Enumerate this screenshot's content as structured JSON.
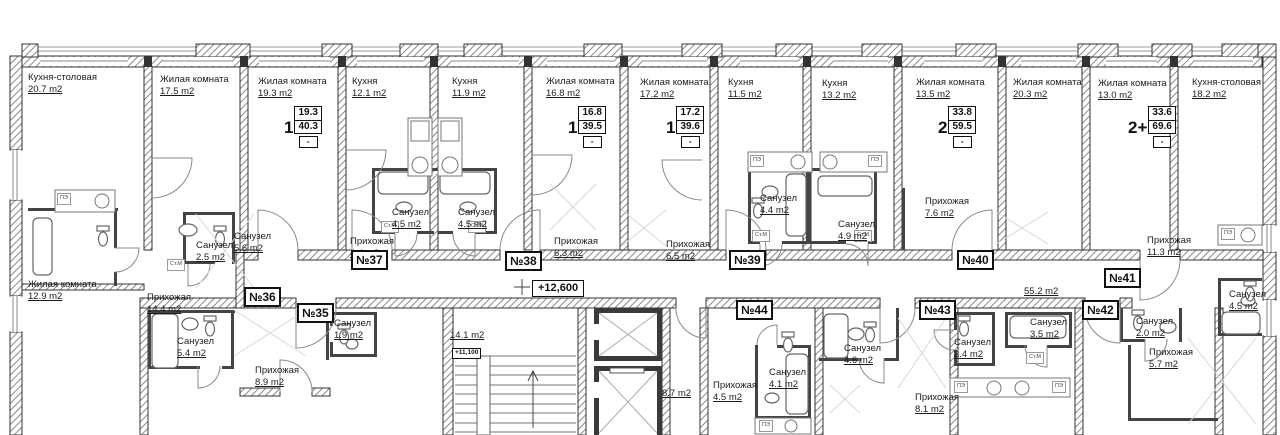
{
  "rooms": [
    {
      "name": "Кухня-столовая",
      "area": "20.7 m2"
    },
    {
      "name": "Жилая комната",
      "area": "17.5 m2"
    },
    {
      "name": "Жилая комната",
      "area": "19.3 m2"
    },
    {
      "name": "Кухня",
      "area": "12.1 m2"
    },
    {
      "name": "Кухня",
      "area": "11.9 m2"
    },
    {
      "name": "Жилая комната",
      "area": "16.8 m2"
    },
    {
      "name": "Жилая комната",
      "area": "17.2 m2"
    },
    {
      "name": "Кухня",
      "area": "11.5 m2"
    },
    {
      "name": "Кухня",
      "area": "13.2 m2"
    },
    {
      "name": "Жилая комната",
      "area": "13.5 m2"
    },
    {
      "name": "Жилая комната",
      "area": "20.3 m2"
    },
    {
      "name": "Жилая комната",
      "area": "13.0 m2"
    },
    {
      "name": "Кухня-столовая",
      "area": "18.2 m2"
    },
    {
      "name": "Санузел",
      "area": "2.5 m2"
    },
    {
      "name": "Санузел",
      "area": "5.6 m2"
    },
    {
      "name": "Жилая комната",
      "area": "12.9 m2"
    },
    {
      "name": "Прихожая",
      "area": "14.4 m2"
    },
    {
      "name": "Санузел",
      "area": "4.5 m2"
    },
    {
      "name": "Санузел",
      "area": "4.5 m2"
    },
    {
      "name": "Прихожая",
      "area": "4.4 m2"
    },
    {
      "name": "Прихожая",
      "area": "6.3 m2"
    },
    {
      "name": "Санузел",
      "area": "4.4 m2"
    },
    {
      "name": "Санузел",
      "area": "4.9 m2"
    },
    {
      "name": "Прихожая",
      "area": "6.5 m2"
    },
    {
      "name": "Прихожая",
      "area": "7.6 m2"
    },
    {
      "name": "Прихожая",
      "area": "11.3 m2"
    },
    {
      "name": "Санузел",
      "area": "4.5 m2"
    },
    {
      "name": "Санузел",
      "area": "5.4 m2"
    },
    {
      "name": "Прихожая",
      "area": "8.9 m2"
    },
    {
      "name": "Санузел",
      "area": "1.9 m2"
    },
    {
      "name": "Прихожая",
      "area": "4.5 m2"
    },
    {
      "name": "Санузел",
      "area": "4.1 m2"
    },
    {
      "name": "Санузел",
      "area": "4.6 m2"
    },
    {
      "name": "Прихожая",
      "area": "8.1 m2"
    },
    {
      "name": "Санузел",
      "area": "2.4 m2"
    },
    {
      "name": "Санузел",
      "area": "3.5 m2"
    },
    {
      "name": "Санузел",
      "area": "2.0 m2"
    },
    {
      "name": "Прихожая",
      "area": "5.7 m2"
    },
    {
      "name": "",
      "area": "55.2 m2"
    },
    {
      "name": "",
      "area": "14.1 m2"
    },
    {
      "name": "",
      "area": "8.7 m2"
    }
  ],
  "apartments": {
    "numbers": [
      "№35",
      "№36",
      "№37",
      "№38",
      "№39",
      "№40",
      "№41",
      "№42",
      "№43",
      "№44"
    ]
  },
  "stamps": [
    {
      "type": "1",
      "living": "19.3",
      "total": "40.3",
      "note": "-"
    },
    {
      "type": "1",
      "living": "16.8",
      "total": "39.5",
      "note": "-"
    },
    {
      "type": "1",
      "living": "17.2",
      "total": "39.6",
      "note": "-"
    },
    {
      "type": "2",
      "living": "33.8",
      "total": "59.5",
      "note": "-"
    },
    {
      "type": "2+",
      "living": "33.6",
      "total": "69.6",
      "note": "-"
    }
  ],
  "marks": {
    "corridor_level": "+12,600",
    "stair_level": "+11,100"
  },
  "appliances": {
    "stove": "ПЭ",
    "washer": "Ст.М"
  }
}
